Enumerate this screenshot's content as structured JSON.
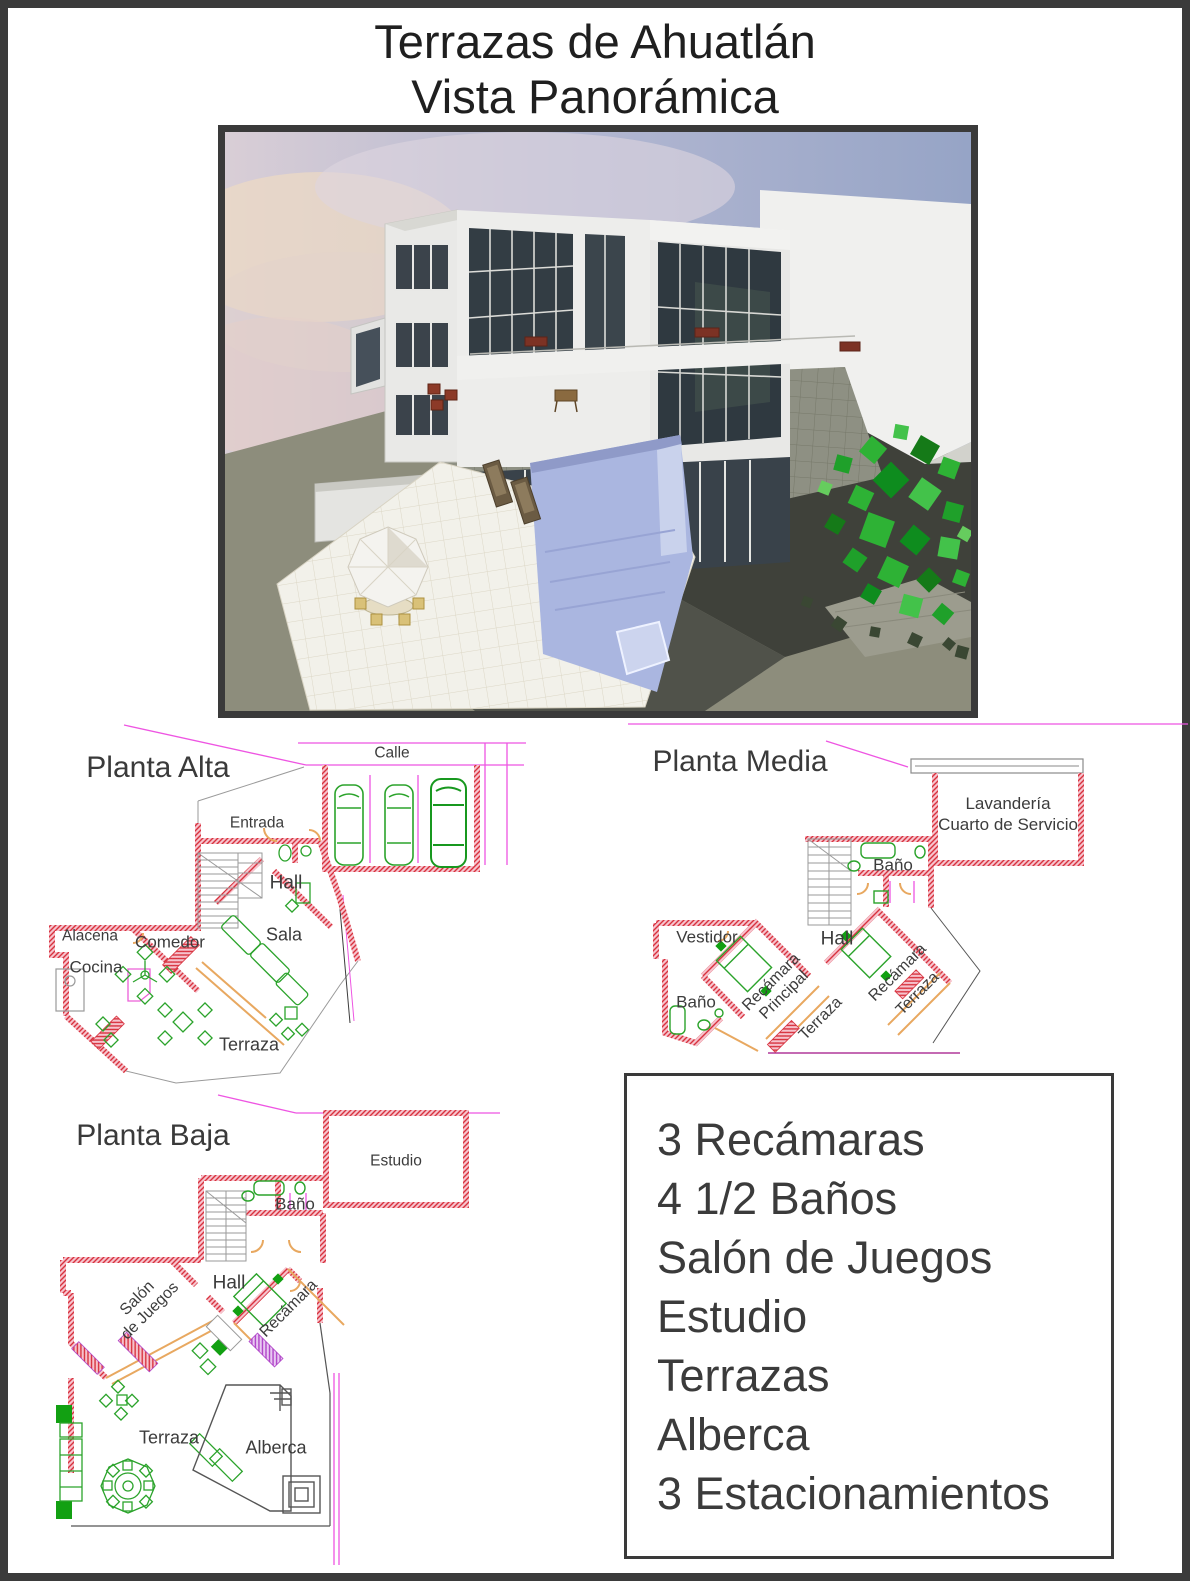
{
  "page": {
    "title_line1": "Terrazas de Ahuatlán",
    "title_line2": "Vista Panorámica"
  },
  "plans": {
    "alta": {
      "title": "Planta Alta",
      "labels": {
        "calle": "Calle",
        "entrada": "Entrada",
        "hall": "Hall",
        "alacena": "Alacena",
        "comedor": "Comedor",
        "cocina": "Cocina",
        "sala": "Sala",
        "terraza": "Terraza"
      }
    },
    "media": {
      "title": "Planta Media",
      "labels": {
        "lavanderia": "Lavandería\nCuarto de Servicio",
        "bano_top": "Baño",
        "vestidor": "Vestidor",
        "hall": "Hall",
        "bano_left": "Baño",
        "recamara_principal": "Recámara\nPrincipal",
        "terraza_left": "Terraza",
        "recamara": "Recámara",
        "terraza_right": "Terraza"
      }
    },
    "baja": {
      "title": "Planta Baja",
      "labels": {
        "estudio": "Estudio",
        "bano": "Baño",
        "hall": "Hall",
        "salon_de_juegos": "Salón\nde Juegos",
        "recamara": "Recámara",
        "terraza": "Terraza",
        "alberca": "Alberca"
      }
    }
  },
  "features": {
    "items": [
      "3 Recámaras",
      "4 1/2 Baños",
      "Salón de Juegos",
      "Estudio",
      "Terrazas",
      "Alberca",
      "3 Estacionamientos"
    ]
  },
  "colors": {
    "frame": "#3a3a3a",
    "wall_red": "#d8323e",
    "wall_fill": "#f8cdd5",
    "guide_magenta": "#ee55e2",
    "furniture_green": "#2ba32b",
    "terrace_tan": "#e8a860",
    "label_gray": "#3c3c3c",
    "pool_blue": "#aab6e0",
    "tree_green": "#2eb235"
  }
}
